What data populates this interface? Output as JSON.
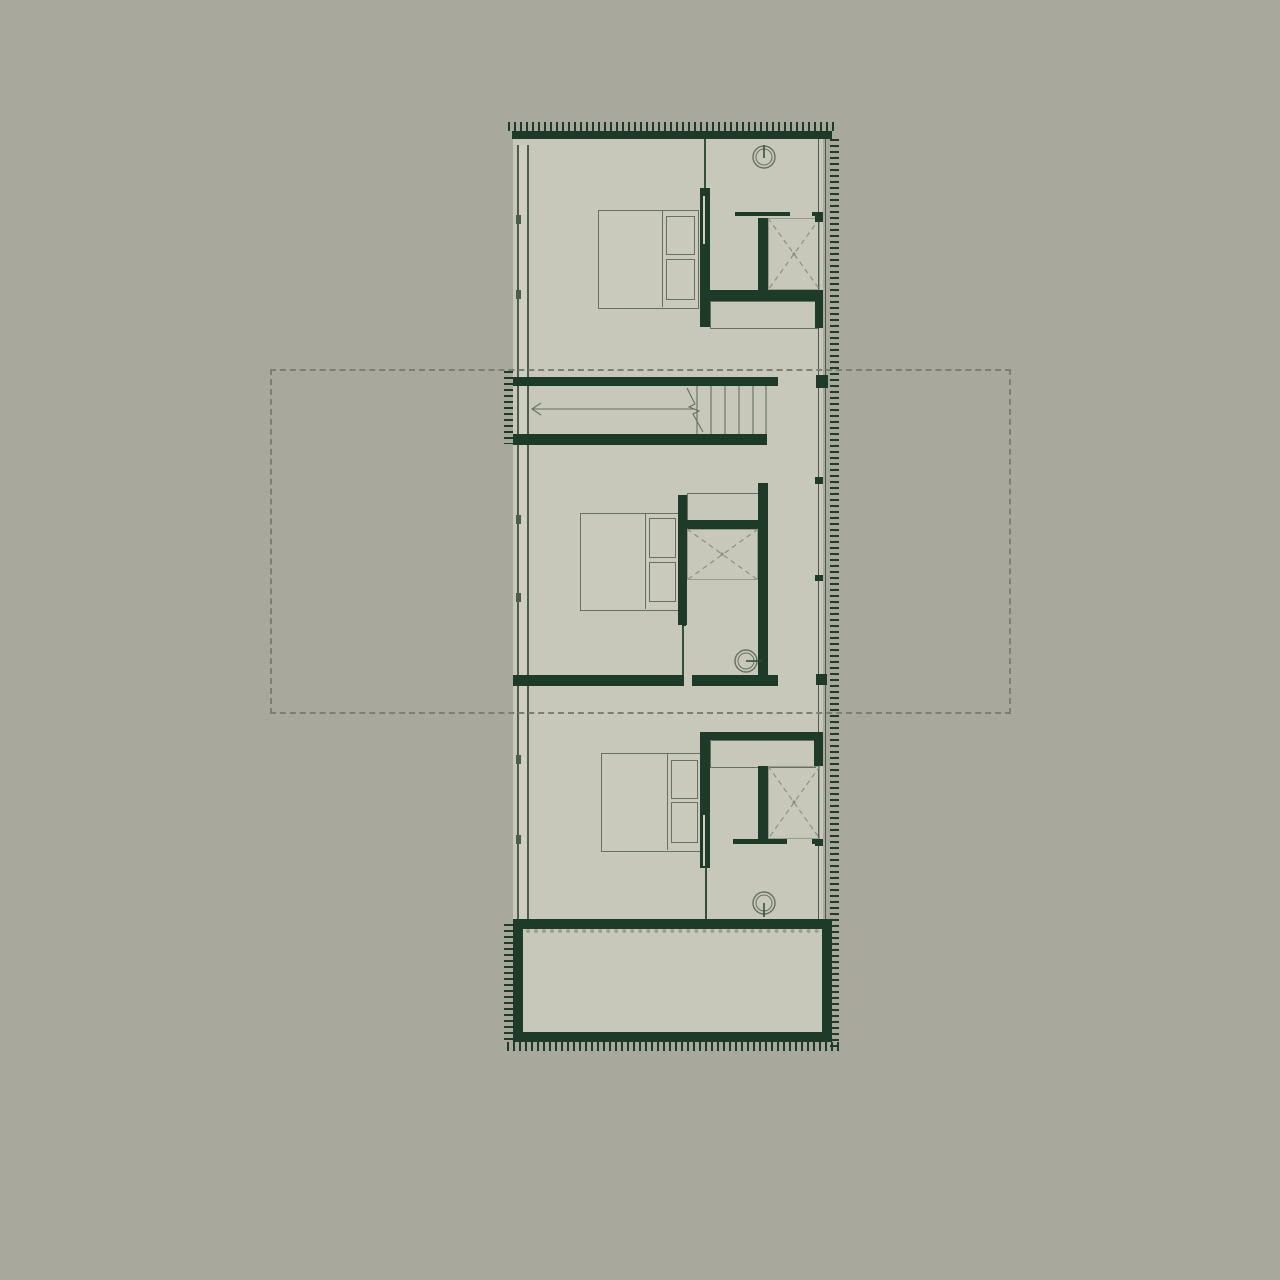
{
  "meta": {
    "drawing_type": "architectural floor plan",
    "description": "Upper-level plan of a narrow linear house: three bedroom modules stacked vertically, a central straight-run staircase, three bathroom cores with wardrobes, glazed side facades with insulation hatching, a dashed setback outline of the level below, and a thick-walled terrace volume at the south end",
    "visible_text": ""
  },
  "palette": {
    "bg": "#a8a99c",
    "floor": "#c7c8ba",
    "floor2": "#c9cabc",
    "wall": "#1e3a28",
    "line": "#66715e",
    "line-dark": "#32503c",
    "dash": "#7b8071",
    "glass": "#4e5c4b",
    "xdash": "#8b9180",
    "scallop": "#99a18c"
  },
  "symbols": [
    {
      "name": "double-bed",
      "count": 3,
      "style": "thin outlined rectangle with two pillows"
    },
    {
      "name": "wardrobe-x",
      "count": 3,
      "style": "dashed diagonal cross in closet bay"
    },
    {
      "name": "round-fixture",
      "count": 3,
      "style": "double circle with stem tick"
    },
    {
      "name": "staircase",
      "count": 1,
      "style": "treads, break line and direction arrow pointing left"
    },
    {
      "name": "pocket-door-wall",
      "count": 2,
      "style": "thick wall with sliding leaf slit"
    },
    {
      "name": "setback-outline",
      "count": 1,
      "style": "dashed rectangle"
    },
    {
      "name": "insulation-hatch",
      "count": 1,
      "style": "tick comb along exterior walls"
    },
    {
      "name": "terrace",
      "count": 1,
      "style": "thick green border rectangle with dotted inner edge"
    }
  ]
}
